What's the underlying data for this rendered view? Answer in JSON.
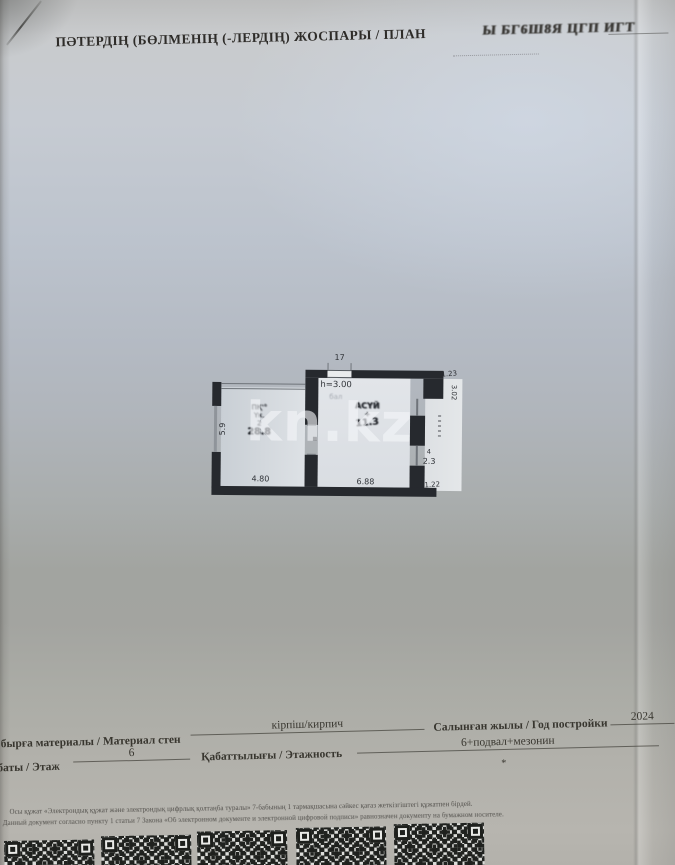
{
  "header": {
    "title": "ПӘТЕРДІҢ (БӨЛМЕНІҢ (-ЛЕРДІҢ) ЖОСПАРЫ / ПЛАН",
    "title_garbled": "Ы БГ6Ш8Я ЦГП ИГТ"
  },
  "watermark": "kn.kz",
  "plan": {
    "top_opening_width": "17",
    "ceiling_height": "h=3.00",
    "faded_note": "бал",
    "rooms": {
      "left": {
        "stamp_lines": [
          "ПҚ'°",
          "Үк.",
          "2"
        ],
        "area": "28.8"
      },
      "kitchen": {
        "stamp_lines": [
          "АСҮЙ",
          "+"
        ],
        "area": "11.3"
      }
    },
    "dimensions": {
      "left_vertical": "5.9",
      "bottom_left": "4.80",
      "bottom_right": "6.88",
      "right_top": "1.23",
      "right_vertical": "3.02",
      "right_small": "4",
      "right_mid": "2.3",
      "right_bottom": "1.22"
    }
  },
  "info": {
    "row1": {
      "label_walls": "бырға материалы / Материал стен",
      "value_walls": "кірпіш/кирпич",
      "label_year": "Салынған жылы / Год постройки",
      "value_year": "2024"
    },
    "row2": {
      "label_floor": "баты / Этаж",
      "value_floor": "6",
      "label_storeys": "Қабаттылығы / Этажность",
      "value_storeys": "6+подвал+мезонин",
      "footnote": "*"
    }
  },
  "footer": {
    "legal_kk": "Осы құжат «Электрондық құжат және электрондық цифрлық қолтаңба туралы» 7-бабының 1 тармақшасына сәйкес қағаз жеткізгіштегі құжатпен бірдей.",
    "legal_ru": "Данный документ согласно пункту 1 статьи 7 Закона «Об электронном документе и электронной цифровой подписи» равнозначен документу на бумажном носителе."
  },
  "colors": {
    "wall": "#26292e",
    "paper": "#b4bac3",
    "watermark": "#f3f6f9",
    "ink": "#33312e"
  }
}
